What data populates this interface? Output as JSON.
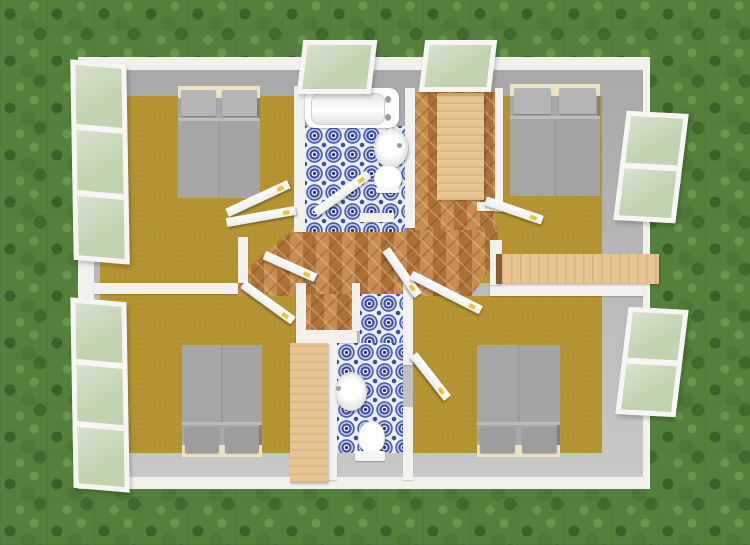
{
  "app": {
    "view_label": "3D aerial view",
    "description": "Top-down 3D rendering of a single-storey house floor plan on a grass lawn"
  },
  "colors": {
    "grass": "#54803c",
    "wall_white": "#f2f1ee",
    "wall_gray": "#adadad",
    "floor_olive": "#b3922f",
    "parquet_base": "#bf8347",
    "tile_bg": "#edeff6",
    "tile_blue": "#3a4ea8",
    "wood_light": "#e6c493",
    "bed_gray": "#a8a8a8",
    "pillow": "#b5b5b5",
    "headboard_cream": "#ece3c4",
    "door_white": "#f8f8f8",
    "handle_yellow": "#e8c53c",
    "glass_green": "#c2d3b2",
    "fixture_white": "#fdfdfd"
  },
  "scene": {
    "rooms": [
      {
        "id": "bedroom-top-left",
        "label": "Bedroom (top left)",
        "floor": "olive"
      },
      {
        "id": "bedroom-top-right",
        "label": "Bedroom (top right)",
        "floor": "olive"
      },
      {
        "id": "bedroom-bottom-left",
        "label": "Bedroom (bottom left)",
        "floor": "olive"
      },
      {
        "id": "bedroom-bottom-right",
        "label": "Bedroom (bottom right)",
        "floor": "olive"
      },
      {
        "id": "bathroom-top",
        "label": "Bathroom (top)",
        "floor": "blue-tile"
      },
      {
        "id": "bathroom-bottom",
        "label": "Bathroom (bottom)",
        "floor": "blue-tile"
      },
      {
        "id": "hallway",
        "label": "Hallway",
        "floor": "herringbone-parquet"
      },
      {
        "id": "dressing-area",
        "label": "Dressing area",
        "floor": "herringbone-parquet"
      }
    ],
    "furniture": [
      {
        "id": "bed-top-left",
        "label": "Double bed"
      },
      {
        "id": "bed-top-right",
        "label": "Double bed"
      },
      {
        "id": "bed-bottom-left",
        "label": "Double bed"
      },
      {
        "id": "bed-bottom-right",
        "label": "Double bed"
      },
      {
        "id": "wardrobe-dressing",
        "label": "Wardrobe"
      },
      {
        "id": "wardrobe-bottom",
        "label": "Wardrobe"
      },
      {
        "id": "sideboard-right",
        "label": "Shelf unit"
      }
    ],
    "fixtures": [
      {
        "id": "bathtub",
        "label": "Bathtub"
      },
      {
        "id": "washbasin-top",
        "label": "Washbasin"
      },
      {
        "id": "toilet-top",
        "label": "Toilet"
      },
      {
        "id": "washbasin-bottom",
        "label": "Washbasin"
      },
      {
        "id": "toilet-bottom",
        "label": "Toilet"
      }
    ],
    "windows": [
      {
        "id": "window-top-1",
        "wall": "top",
        "state": "open"
      },
      {
        "id": "window-top-2",
        "wall": "top",
        "state": "open"
      },
      {
        "id": "window-left-1",
        "wall": "left",
        "state": "open"
      },
      {
        "id": "window-left-2",
        "wall": "left",
        "state": "open"
      },
      {
        "id": "window-right-1",
        "wall": "right",
        "state": "open"
      },
      {
        "id": "window-right-2",
        "wall": "right",
        "state": "open"
      }
    ],
    "doors": [
      {
        "id": "door-bathroom-top",
        "state": "open"
      },
      {
        "id": "door-bedroom-top-left-a",
        "state": "open"
      },
      {
        "id": "door-bedroom-top-left-b",
        "state": "open"
      },
      {
        "id": "door-bedroom-bottom-left",
        "state": "open"
      },
      {
        "id": "door-hall-center",
        "state": "open"
      },
      {
        "id": "door-hall-corridor",
        "state": "open"
      },
      {
        "id": "door-bedroom-top-right",
        "state": "open"
      },
      {
        "id": "door-bedroom-bottom-right-a",
        "state": "open"
      },
      {
        "id": "door-bedroom-bottom-right-b",
        "state": "open"
      }
    ]
  }
}
